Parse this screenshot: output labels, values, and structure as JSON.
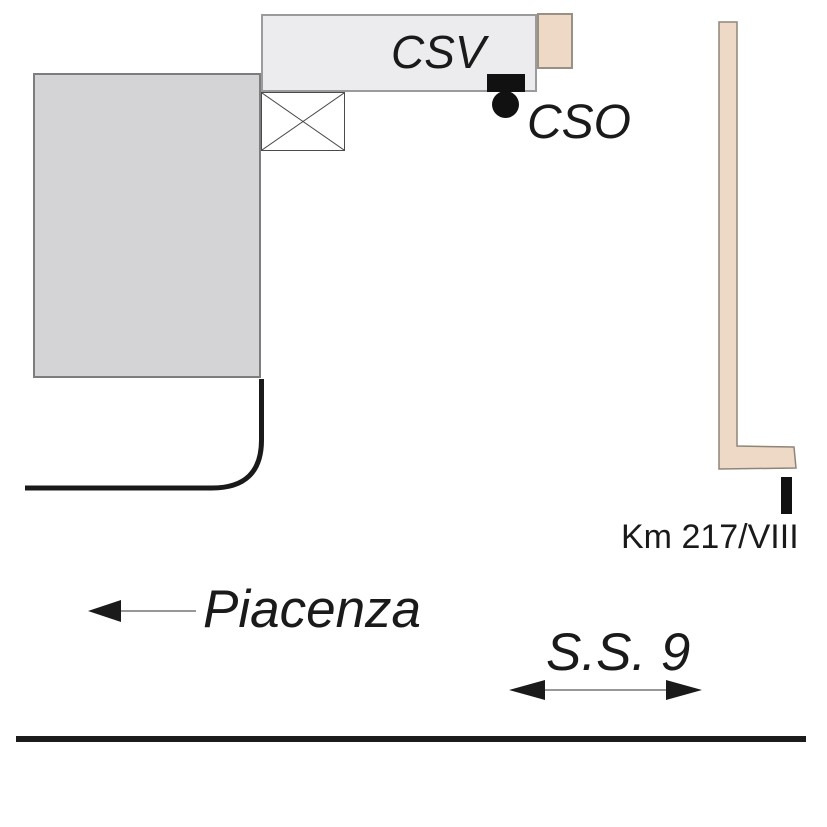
{
  "diagram": {
    "type": "site-location-sketch",
    "labels": {
      "csv": "CSV",
      "cso": "CSO",
      "km_marker": "Km 217/VIII",
      "direction_west": "Piacenza",
      "road_name": "S.S. 9"
    },
    "markers": {
      "csv_marker_shape": "filled-square",
      "cso_marker_shape": "filled-circle",
      "km_marker_shape": "vertical-tick"
    },
    "colors": {
      "background": "#ffffff",
      "large_building_fill": "#d4d4d6",
      "large_building_border": "#7d7d7d",
      "csv_building_fill": "#ececee",
      "csv_building_border": "#9b9b9b",
      "road_strip_fill": "#eed9c7",
      "road_strip_border": "#8e8578",
      "ink": "#1a1a1a",
      "arrow_shaft": "#777777"
    }
  }
}
